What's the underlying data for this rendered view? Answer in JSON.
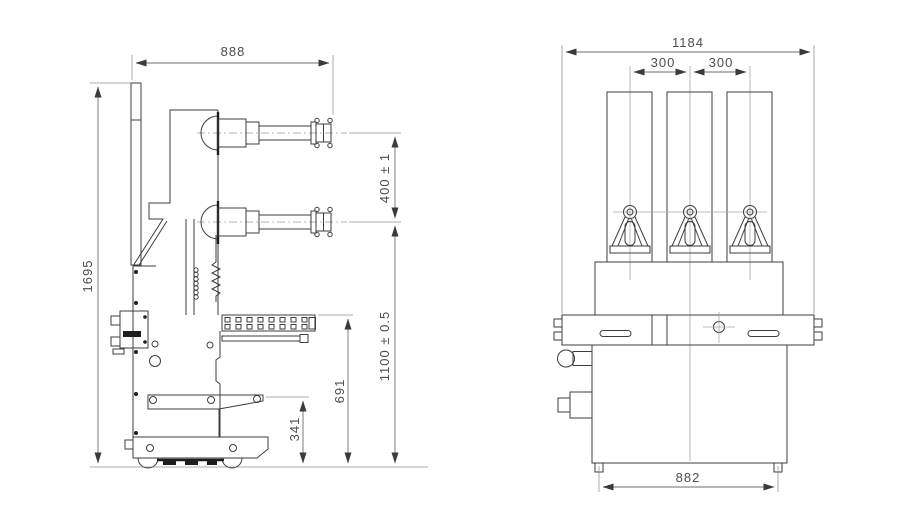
{
  "colors": {
    "background": "#ffffff",
    "outline": "#3d3d3d",
    "dimension_line": "#6e6e6e",
    "dimension_text": "#4d4d4d"
  },
  "side_view": {
    "dimensions": {
      "overall_width": "888",
      "overall_height": "1695",
      "terminal_spacing": "400 ± 1",
      "lower_terminal_height": "1100 ± 0.5",
      "rail_height": "691",
      "bracket_height": "341"
    }
  },
  "front_view": {
    "dimensions": {
      "overall_width": "1184",
      "pole_spacing_left": "300",
      "pole_spacing_right": "300",
      "base_width": "882"
    }
  }
}
